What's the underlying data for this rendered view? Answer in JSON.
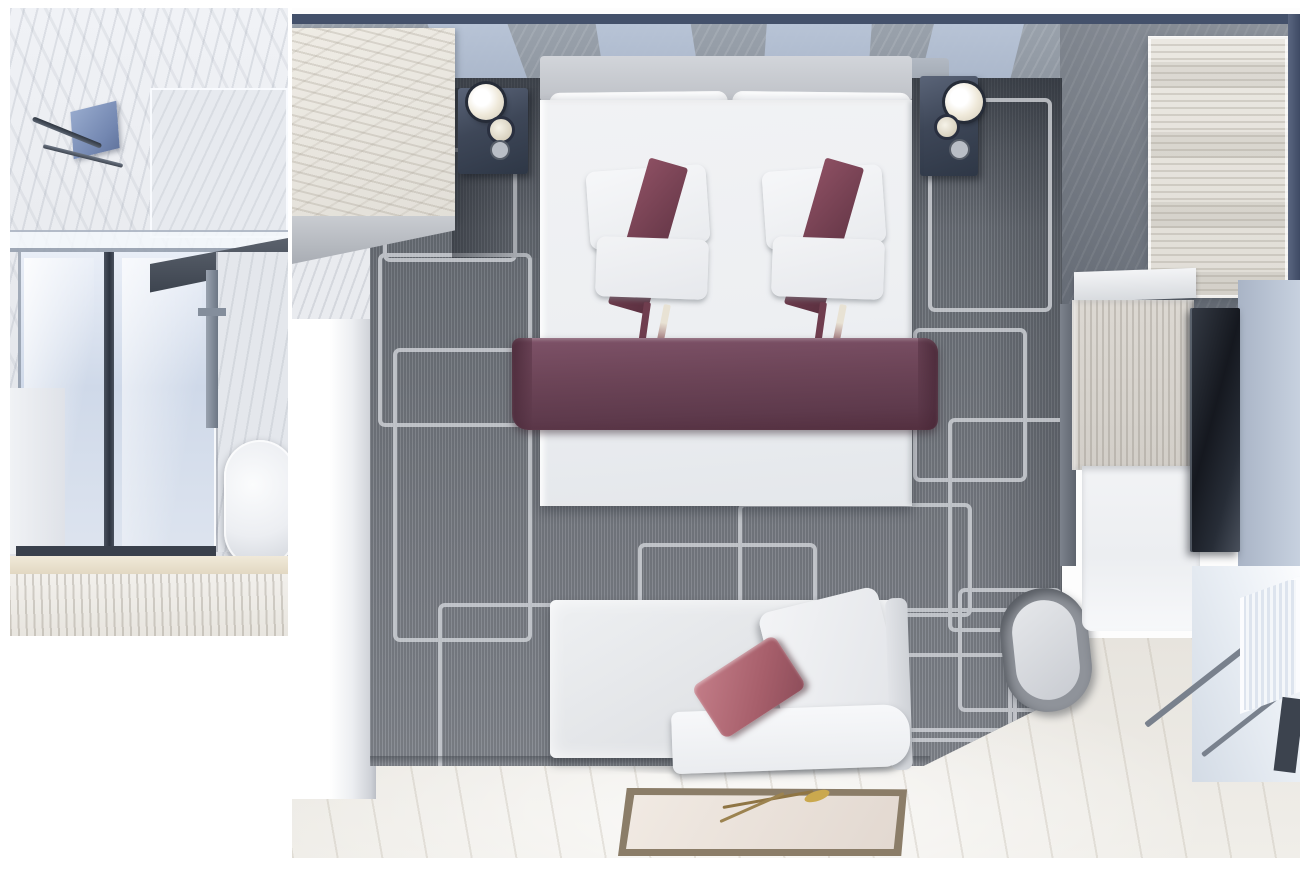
{
  "scene": {
    "kind": "3d-rendered top-down floor plan of a cabin stateroom with bathroom inset",
    "panels": {
      "bathroom_inset": {
        "objects": [
          "marble-wall",
          "shower-head",
          "towel-bar",
          "glass-shower-door",
          "wall-pipe",
          "toilet",
          "vanity-block",
          "wood-floor-strip"
        ]
      },
      "main_room": {
        "objects": [
          "top-wall-panels",
          "wardrobe-cabinet-left",
          "nightstand-left",
          "table-lamp-left",
          "nightstand-right",
          "table-lamp-right",
          "headboard",
          "double-bed",
          "pillow-cluster-left",
          "pillow-cluster-right",
          "bed-runner",
          "patterned-carpet",
          "left-wall",
          "sofa",
          "sofa-throw-pillow",
          "floor-rug-with-flower",
          "wood-floor",
          "wardrobe-right",
          "vanity-desk",
          "desk-shelf",
          "wall-tv",
          "stool",
          "balcony-window",
          "right-wall"
        ]
      }
    }
  },
  "colors": {
    "marble": "#e9ebef",
    "frame_navy": "#44516b",
    "carpet_gray": "#7b7f86",
    "bed_white": "#f1f2f4",
    "bed_runner_plum": "#6d4558",
    "pillow_sash": "#6f3d4e",
    "sofa_cushion_rose": "#a75f6b",
    "rug_border_brown": "#8b7d68",
    "rug_flower_red": "#c7402e",
    "tv_black": "#15181f",
    "stool_ring": "#8f939a",
    "carpet_pattern_line": "#d2d5da",
    "wood_light": "#e8e5df",
    "wall_blue_gray": "#b5c1d3",
    "wall_dark_gray": "#6b717b",
    "floor_wood": "#efede8"
  }
}
